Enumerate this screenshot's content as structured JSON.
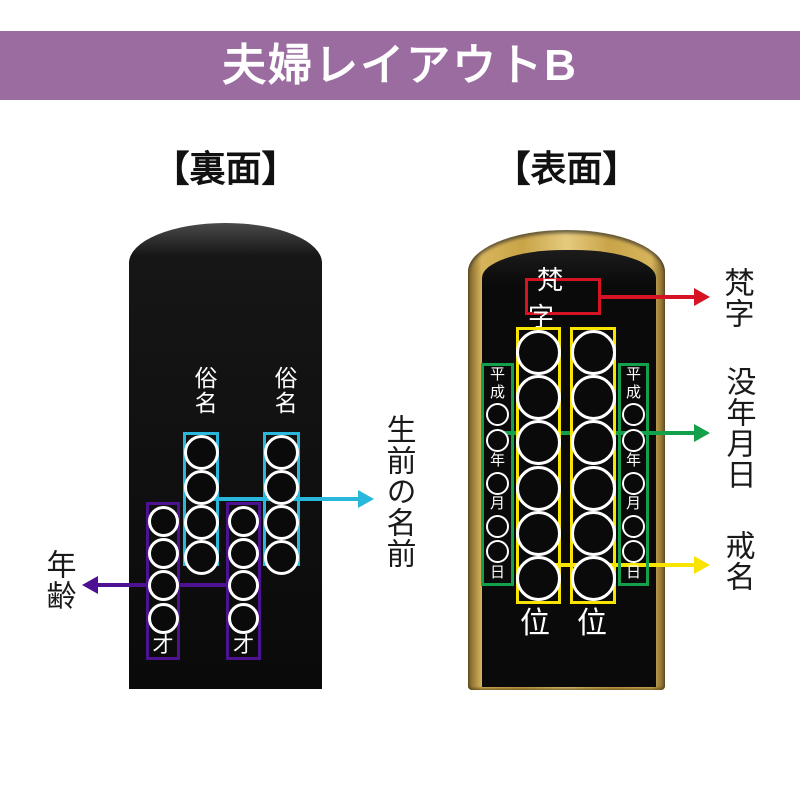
{
  "banner": {
    "title": "夫婦レイアウトB"
  },
  "colors": {
    "banner_bg": "#9B6CA0",
    "cyan": "#29B7DB",
    "purple": "#4D1191",
    "green": "#12A04A",
    "yellow": "#F9E400",
    "red": "#D51322",
    "gold": "#C9A448",
    "tablet_black": "#0A0A0A"
  },
  "back": {
    "heading": "【裏面】",
    "columns": [
      {
        "label": "俗名",
        "age_suffix": "才"
      },
      {
        "label": "俗名",
        "age_suffix": "才"
      }
    ],
    "name_box_circles": 4,
    "age_box_circles": 4,
    "annotation_name": "生前の名前",
    "annotation_age": "年齢"
  },
  "front": {
    "heading": "【表面】",
    "bonji_text": "梵字",
    "kaimyo_circles": 6,
    "date_columns": [
      [
        "平",
        "成",
        "○",
        "○",
        "年",
        "○",
        "月",
        "○",
        "○",
        "日"
      ],
      [
        "平",
        "成",
        "○",
        "○",
        "年",
        "○",
        "月",
        "○",
        "○",
        "日"
      ]
    ],
    "rank_labels": [
      "位",
      "位"
    ],
    "annotation_bonji": "梵字",
    "annotation_death_date": "没年月日",
    "annotation_kaimyo": "戒名"
  }
}
